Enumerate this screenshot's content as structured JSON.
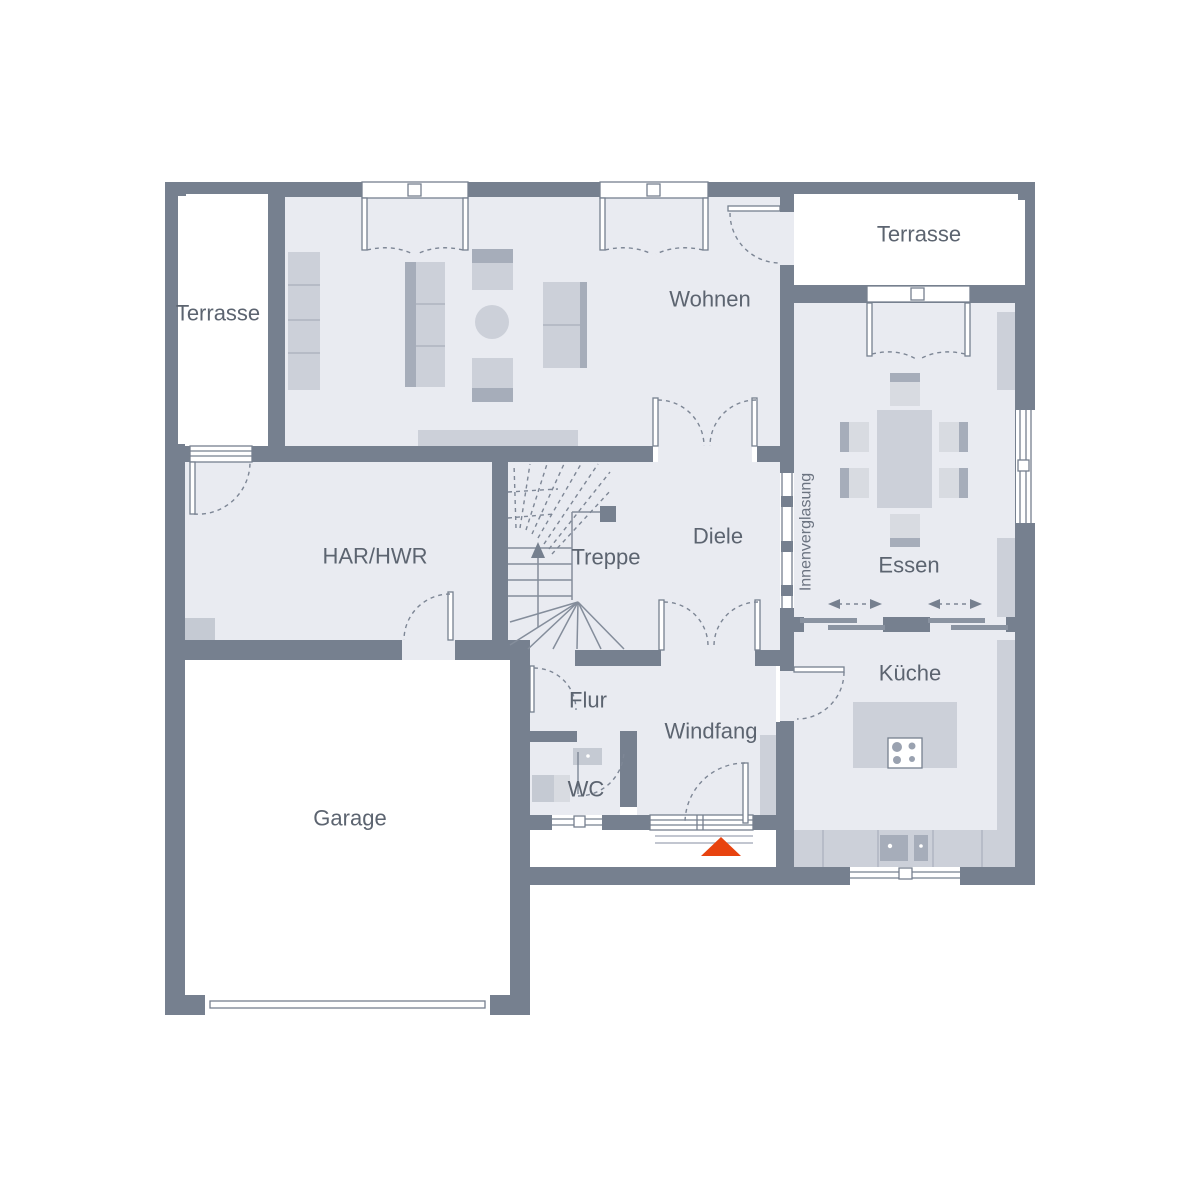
{
  "plan_type": "floor-plan",
  "colors": {
    "wall": "#76808F",
    "floor": "#E9EBF1",
    "outdoor": "#FFFFFF",
    "furniture": "#CCD0D9",
    "furniture_dark": "#A6ADBA",
    "label_text": "#5C6470",
    "entrance_marker": "#E8430F"
  },
  "rooms": [
    {
      "id": "terrasse-left",
      "label": "Terrasse"
    },
    {
      "id": "wohnen",
      "label": "Wohnen"
    },
    {
      "id": "terrasse-right",
      "label": "Terrasse"
    },
    {
      "id": "har-hwr",
      "label": "HAR/HWR"
    },
    {
      "id": "treppe",
      "label": "Treppe"
    },
    {
      "id": "diele",
      "label": "Diele"
    },
    {
      "id": "essen",
      "label": "Essen"
    },
    {
      "id": "flur",
      "label": "Flur"
    },
    {
      "id": "windfang",
      "label": "Windfang"
    },
    {
      "id": "wc",
      "label": "WC"
    },
    {
      "id": "kueche",
      "label": "Küche"
    },
    {
      "id": "garage",
      "label": "Garage"
    }
  ],
  "annotations": {
    "glazing_label": "Innenverglasung"
  }
}
